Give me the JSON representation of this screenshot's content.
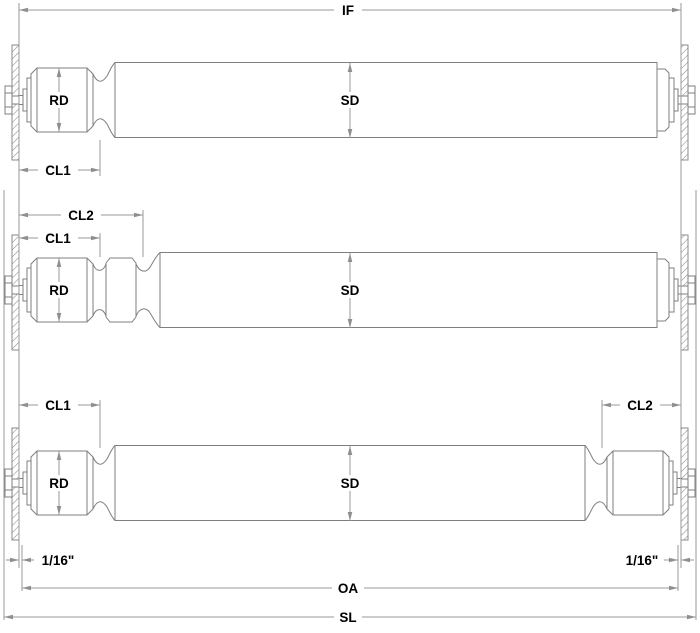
{
  "diagram_title": "roller-axle-dimension-drawing",
  "colors": {
    "background": "#ffffff",
    "part_outline": "#7f7f7f",
    "dimension_line": "#9a9a9a",
    "hatch": "#8a8a8a",
    "label_text": "#000000"
  },
  "labels": {
    "if": "IF",
    "sd": "SD",
    "rd": "RD",
    "cl1": "CL1",
    "cl2": "CL2",
    "oa": "OA",
    "sl": "SL",
    "sixteenth": "1/16\""
  }
}
